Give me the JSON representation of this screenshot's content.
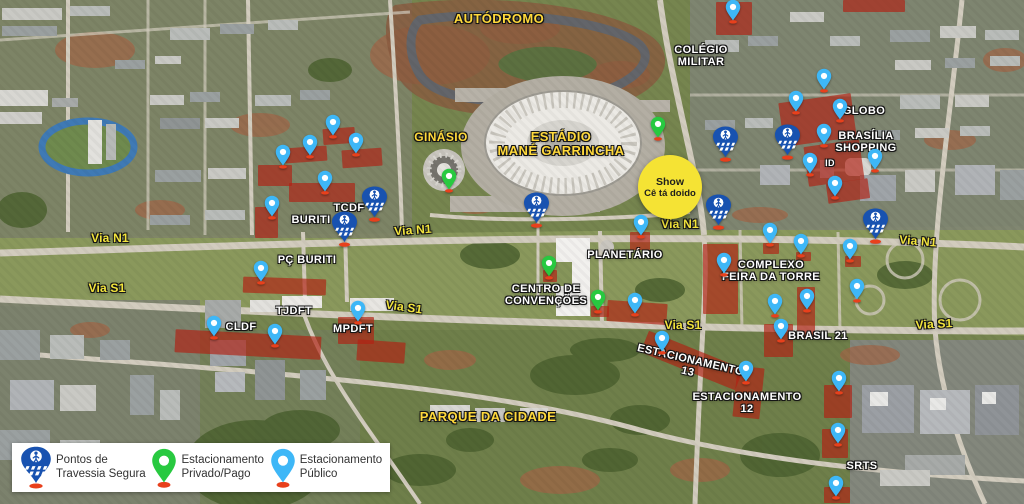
{
  "legend": {
    "items": [
      {
        "type": "crossing",
        "label": "Pontos de\nTravessia Segura"
      },
      {
        "type": "private",
        "label": "Estacionamento\nPrivado/Pago"
      },
      {
        "type": "public",
        "label": "Estacionamento\nPúblico"
      }
    ]
  },
  "highlight": {
    "line1": "Show",
    "line2": "Cê tá doido",
    "x": 670,
    "y": 187,
    "r": 32
  },
  "labels": [
    {
      "t": "AUTÓDROMO",
      "x": 499,
      "y": 12,
      "s": 13,
      "c": "yellow",
      "r": 0
    },
    {
      "t": "GINÁSIO",
      "x": 441,
      "y": 131,
      "s": 12,
      "c": "yellow",
      "r": 0
    },
    {
      "t": "ESTÁDIO\nMANÉ GARRINCHA",
      "x": 561,
      "y": 130,
      "s": 13,
      "c": "yellow",
      "r": 0
    },
    {
      "t": "PARQUE DA CIDADE",
      "x": 488,
      "y": 410,
      "s": 13,
      "c": "yellow",
      "r": 0
    },
    {
      "t": "COLÉGIO\nMILITAR",
      "x": 701,
      "y": 45,
      "s": 11,
      "c": "white",
      "r": 0
    },
    {
      "t": "GLOBO",
      "x": 864,
      "y": 106,
      "s": 11,
      "c": "white",
      "r": 0
    },
    {
      "t": "BRASÍLIA\nSHOPPING",
      "x": 866,
      "y": 131,
      "s": 11,
      "c": "white",
      "r": 0
    },
    {
      "t": "ID",
      "x": 830,
      "y": 159,
      "s": 9,
      "c": "white",
      "r": 0
    },
    {
      "t": "TCDF",
      "x": 349,
      "y": 203,
      "s": 11,
      "c": "white",
      "r": 0
    },
    {
      "t": "BURITI",
      "x": 311,
      "y": 215,
      "s": 11,
      "c": "white",
      "r": 0
    },
    {
      "t": "PÇ BURITI",
      "x": 307,
      "y": 255,
      "s": 11,
      "c": "white",
      "r": 0
    },
    {
      "t": "TJDFT",
      "x": 294,
      "y": 306,
      "s": 11,
      "c": "white",
      "r": 0
    },
    {
      "t": "CLDF",
      "x": 241,
      "y": 322,
      "s": 11,
      "c": "white",
      "r": 0
    },
    {
      "t": "MPDFT",
      "x": 353,
      "y": 324,
      "s": 11,
      "c": "white",
      "r": 0
    },
    {
      "t": "PLANETÁRIO",
      "x": 625,
      "y": 250,
      "s": 11,
      "c": "white",
      "r": 0
    },
    {
      "t": "CENTRO DE\nCONVENÇÕES",
      "x": 546,
      "y": 284,
      "s": 11,
      "c": "white",
      "r": 0
    },
    {
      "t": "COMPLEXO\nFEIRA DA TORRE",
      "x": 771,
      "y": 260,
      "s": 11,
      "c": "white",
      "r": 0
    },
    {
      "t": "BRASIL 21",
      "x": 818,
      "y": 331,
      "s": 11,
      "c": "white",
      "r": 0
    },
    {
      "t": "ESTACIONAMENTO\n13",
      "x": 689,
      "y": 355,
      "s": 11,
      "c": "white",
      "r": 13
    },
    {
      "t": "ESTACIONAMENTO\n12",
      "x": 747,
      "y": 392,
      "s": 11,
      "c": "white",
      "r": 0
    },
    {
      "t": "SRTS",
      "x": 862,
      "y": 461,
      "s": 11,
      "c": "white",
      "r": 0
    },
    {
      "t": "Via N1",
      "x": 110,
      "y": 232,
      "s": 12,
      "c": "via",
      "r": 0
    },
    {
      "t": "Via N1",
      "x": 413,
      "y": 224,
      "s": 12,
      "c": "via",
      "r": -4
    },
    {
      "t": "Via N1",
      "x": 680,
      "y": 218,
      "s": 12,
      "c": "via",
      "r": 0
    },
    {
      "t": "Via N1",
      "x": 918,
      "y": 235,
      "s": 12,
      "c": "via",
      "r": 5
    },
    {
      "t": "Via S1",
      "x": 107,
      "y": 282,
      "s": 12,
      "c": "via",
      "r": 0
    },
    {
      "t": "Via S1",
      "x": 404,
      "y": 301,
      "s": 12,
      "c": "via",
      "r": 8
    },
    {
      "t": "Via S1",
      "x": 683,
      "y": 319,
      "s": 12,
      "c": "via",
      "r": 0
    },
    {
      "t": "Via S1",
      "x": 934,
      "y": 318,
      "s": 12,
      "c": "via",
      "r": -3
    }
  ],
  "pins": {
    "public": [
      [
        733,
        24
      ],
      [
        824,
        93
      ],
      [
        796,
        115
      ],
      [
        840,
        123
      ],
      [
        824,
        148
      ],
      [
        810,
        177
      ],
      [
        875,
        173
      ],
      [
        835,
        200
      ],
      [
        333,
        139
      ],
      [
        310,
        159
      ],
      [
        283,
        169
      ],
      [
        356,
        157
      ],
      [
        325,
        195
      ],
      [
        272,
        220
      ],
      [
        261,
        285
      ],
      [
        214,
        340
      ],
      [
        275,
        348
      ],
      [
        358,
        325
      ],
      [
        641,
        239
      ],
      [
        635,
        317
      ],
      [
        724,
        277
      ],
      [
        770,
        247
      ],
      [
        801,
        258
      ],
      [
        850,
        263
      ],
      [
        807,
        313
      ],
      [
        857,
        303
      ],
      [
        775,
        318
      ],
      [
        781,
        343
      ],
      [
        662,
        355
      ],
      [
        746,
        385
      ],
      [
        839,
        395
      ],
      [
        838,
        447
      ],
      [
        836,
        500
      ]
    ],
    "private": [
      [
        449,
        193
      ],
      [
        658,
        141
      ],
      [
        549,
        280
      ],
      [
        598,
        314
      ]
    ],
    "crossing": [
      [
        536,
        228
      ],
      [
        374,
        222
      ],
      [
        344,
        247
      ],
      [
        725,
        162
      ],
      [
        787,
        160
      ],
      [
        718,
        230
      ],
      [
        875,
        244
      ]
    ]
  },
  "red_zones": [
    [
      716,
      2,
      36,
      33,
      0
    ],
    [
      843,
      0,
      62,
      12,
      0
    ],
    [
      781,
      98,
      73,
      44,
      -8
    ],
    [
      806,
      143,
      56,
      40,
      -8
    ],
    [
      827,
      181,
      42,
      20,
      -8
    ],
    [
      323,
      128,
      32,
      16,
      -4
    ],
    [
      285,
      147,
      42,
      15,
      -4
    ],
    [
      342,
      149,
      40,
      18,
      -4
    ],
    [
      258,
      165,
      34,
      21,
      0
    ],
    [
      289,
      183,
      66,
      19,
      0
    ],
    [
      255,
      207,
      23,
      31,
      0
    ],
    [
      243,
      278,
      83,
      16,
      2
    ],
    [
      175,
      333,
      146,
      23,
      3
    ],
    [
      338,
      317,
      36,
      27,
      0
    ],
    [
      357,
      341,
      48,
      21,
      4
    ],
    [
      630,
      232,
      20,
      18,
      0
    ],
    [
      607,
      302,
      60,
      21,
      4
    ],
    [
      703,
      244,
      35,
      70,
      0
    ],
    [
      797,
      287,
      18,
      51,
      0
    ],
    [
      764,
      324,
      29,
      33,
      0
    ],
    [
      641,
      349,
      102,
      23,
      22
    ],
    [
      735,
      367,
      27,
      51,
      6
    ],
    [
      824,
      385,
      28,
      33,
      0
    ],
    [
      822,
      429,
      26,
      29,
      0
    ],
    [
      824,
      487,
      26,
      16,
      0
    ],
    [
      543,
      270,
      14,
      12,
      0
    ],
    [
      591,
      306,
      18,
      11,
      0
    ],
    [
      763,
      243,
      16,
      11,
      0
    ],
    [
      796,
      252,
      15,
      9,
      0
    ],
    [
      845,
      256,
      16,
      11,
      0
    ]
  ],
  "colors": {
    "public_pin": "#3eb7f7",
    "private_pin": "#28c940",
    "crossing_pin": "#1852b0",
    "pin_base": "#e8401c",
    "red_zone": "rgba(178,32,18,0.66)",
    "highlight_yellow": "#f5e334"
  }
}
